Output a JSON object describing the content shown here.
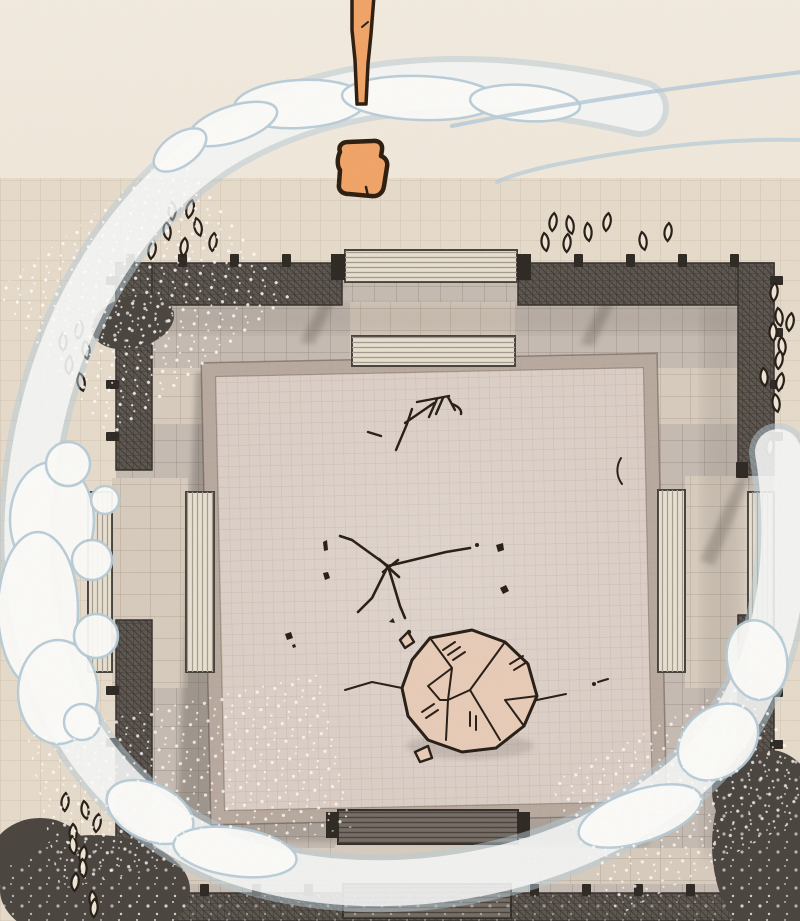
{
  "scene": {
    "type": "manga-panel",
    "setting": "overhead aerial view of a walled stone courtyard arena with a large square platform at its center",
    "elements": [
      "orange-robed figure seen from above at the top gate",
      "long vertical staff extending off the top edge",
      "white wind swirl ring with pale blue outline circling the arena",
      "large cracked boulder resting on the platform",
      "impact crack and scratch marks on the platform surface",
      "scattered almond-shaped leaf marks around the walls",
      "four gate stairways (top, left, right, bottom)",
      "dark perimeter wall with evenly spaced posts",
      "speckled shrubs at the wall corners"
    ]
  },
  "colors": {
    "cream_top": "#f1e9db",
    "cream_tile": "#e8ddcd",
    "yard": "#c6bcb3",
    "path_light": "#d8cdbf",
    "platform_rim": "#b9aaa0",
    "platform": "#dccfc7",
    "wall": "#5b544e",
    "wall_dark": "#2b2620",
    "stair_light": "#e9e1d2",
    "stair_dark": "#746c64",
    "ink": "#241b13",
    "orange": "#f3a466",
    "orange_outline": "#2a1a0c",
    "swirl_blue": "#b7cdda",
    "swirl_white": "#fdfdfb",
    "boulder": "#e9cdb9",
    "shadow": "#575048",
    "bush": "#48423d",
    "leaf_fill": "#f0e7d9"
  },
  "counts": {
    "leaf_marks_upper_left": 7,
    "leaf_marks_upper_right": 8,
    "leaf_marks_right_column": 10,
    "leaf_marks_left_column": 5,
    "leaf_marks_lower_left": 10,
    "leaf_marks_total": 40,
    "gates": 4,
    "stairways": 8,
    "crack_clusters": 3,
    "debris_chips": 6
  }
}
